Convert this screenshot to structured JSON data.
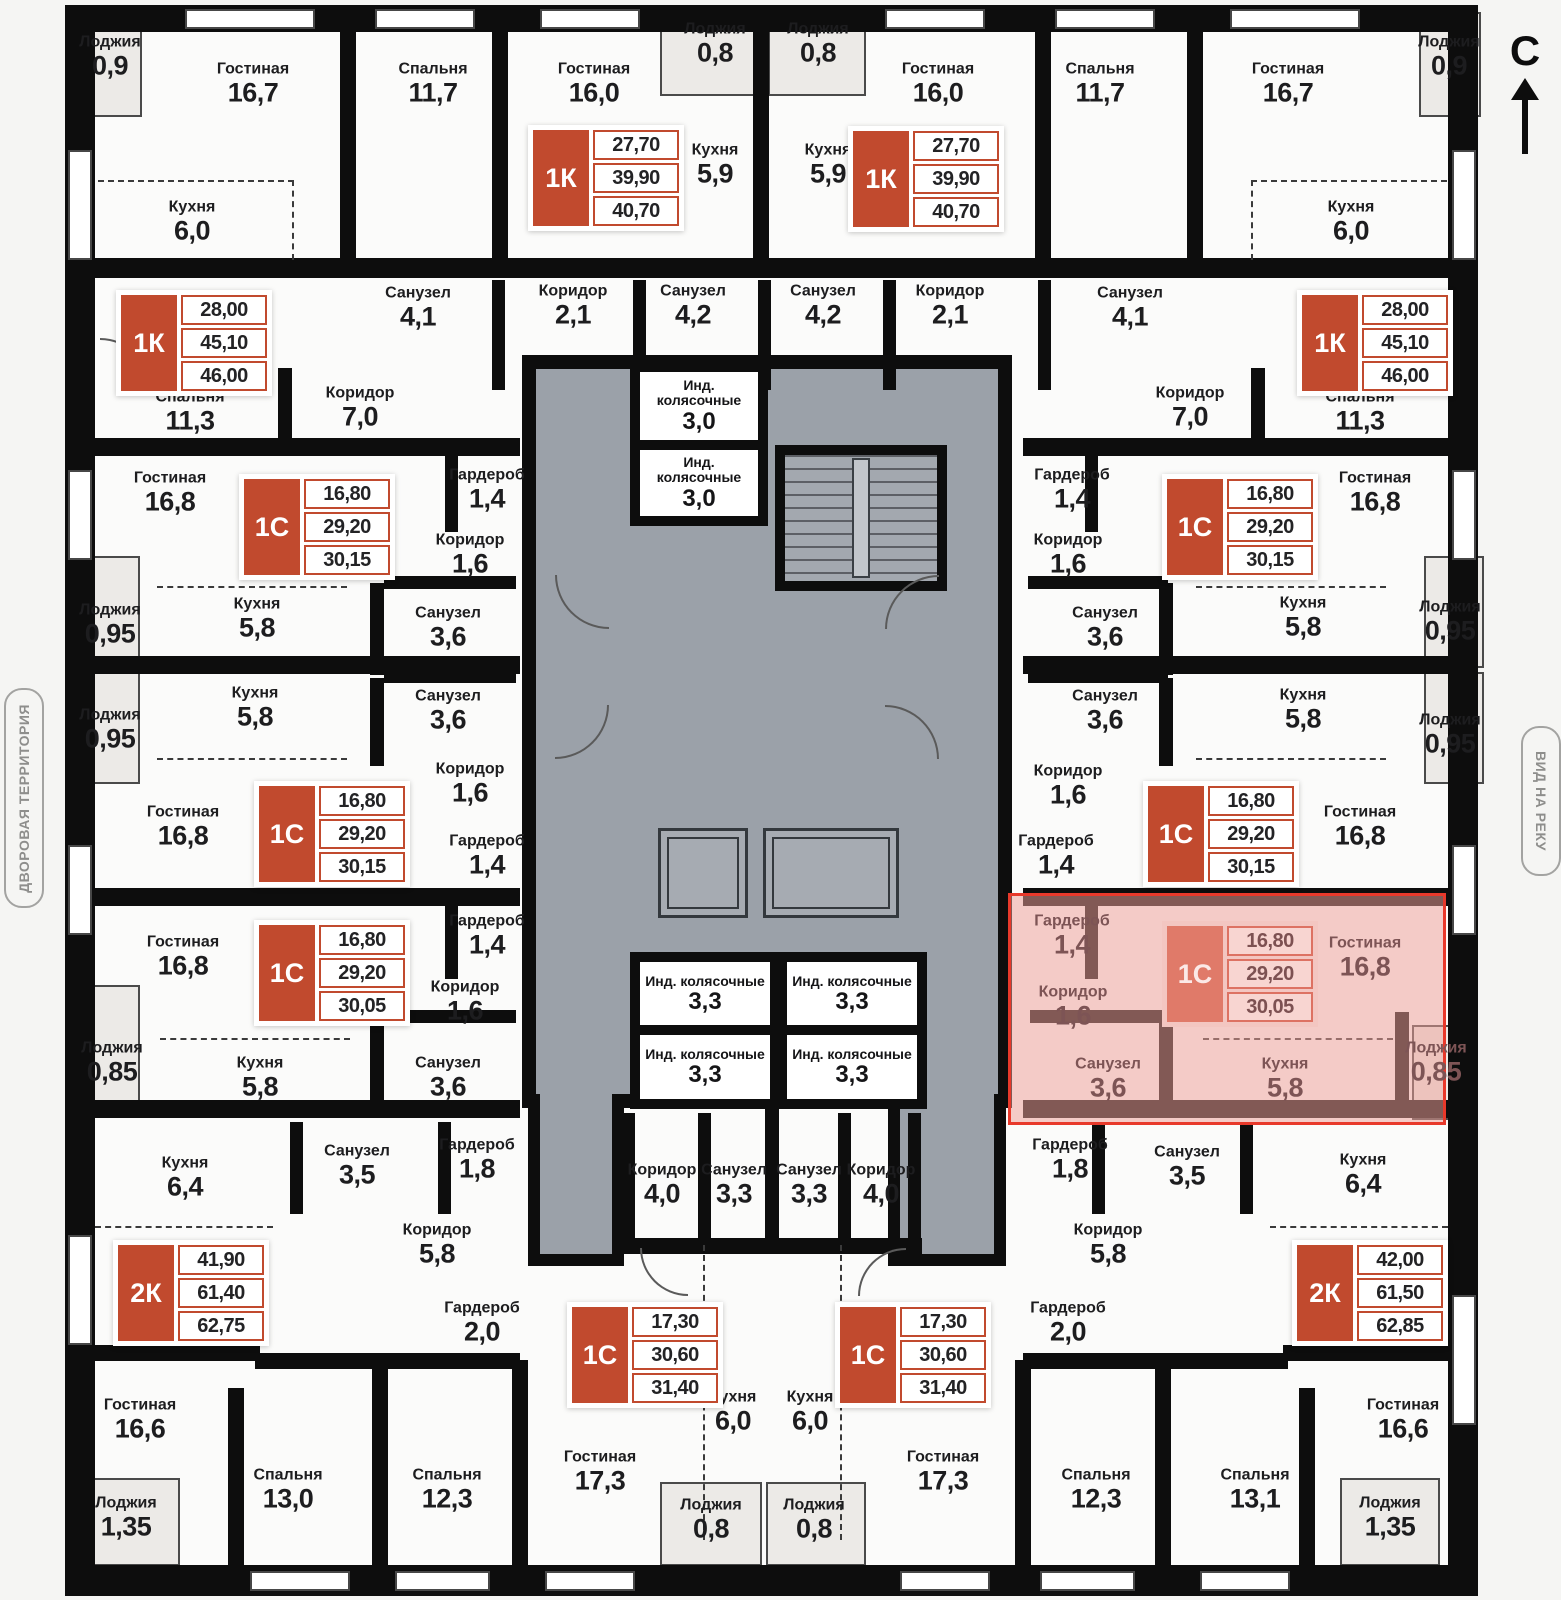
{
  "compass": {
    "label": "С"
  },
  "side_labels": {
    "left": "ДВОРОВАЯ ТЕРРИТОРИЯ",
    "right": "ВИД НА РЕКУ"
  },
  "colors": {
    "card_red": "#c14a2e",
    "wall_black": "#0d0d0d",
    "core_gray": "#9ba1a9",
    "highlight_fill": "#edA098",
    "highlight_border": "#e8392b",
    "highlight_text": "#7d5455"
  },
  "highlight": {
    "x": 1008,
    "y": 893,
    "w": 438,
    "h": 232
  },
  "cards": [
    {
      "type": "1К",
      "values": [
        "27,70",
        "39,90",
        "40,70"
      ],
      "x": 528,
      "y": 125,
      "hl": false
    },
    {
      "type": "1К",
      "values": [
        "27,70",
        "39,90",
        "40,70"
      ],
      "x": 848,
      "y": 126,
      "hl": false
    },
    {
      "type": "1К",
      "values": [
        "28,00",
        "45,10",
        "46,00"
      ],
      "x": 116,
      "y": 290,
      "hl": false
    },
    {
      "type": "1К",
      "values": [
        "28,00",
        "45,10",
        "46,00"
      ],
      "x": 1297,
      "y": 290,
      "hl": false
    },
    {
      "type": "1С",
      "values": [
        "16,80",
        "29,20",
        "30,15"
      ],
      "x": 239,
      "y": 474,
      "hl": false
    },
    {
      "type": "1С",
      "values": [
        "16,80",
        "29,20",
        "30,15"
      ],
      "x": 1162,
      "y": 474,
      "hl": false
    },
    {
      "type": "1С",
      "values": [
        "16,80",
        "29,20",
        "30,15"
      ],
      "x": 254,
      "y": 781,
      "hl": false
    },
    {
      "type": "1С",
      "values": [
        "16,80",
        "29,20",
        "30,15"
      ],
      "x": 1143,
      "y": 781,
      "hl": false
    },
    {
      "type": "1С",
      "values": [
        "16,80",
        "29,20",
        "30,05"
      ],
      "x": 254,
      "y": 920,
      "hl": false
    },
    {
      "type": "1С",
      "values": [
        "16,80",
        "29,20",
        "30,05"
      ],
      "x": 1162,
      "y": 921,
      "hl": true
    },
    {
      "type": "2К",
      "values": [
        "41,90",
        "61,40",
        "62,75"
      ],
      "x": 113,
      "y": 1240,
      "hl": false
    },
    {
      "type": "2К",
      "values": [
        "42,00",
        "61,50",
        "62,85"
      ],
      "x": 1292,
      "y": 1240,
      "hl": false
    },
    {
      "type": "1С",
      "values": [
        "17,30",
        "30,60",
        "31,40"
      ],
      "x": 567,
      "y": 1302,
      "hl": false
    },
    {
      "type": "1С",
      "values": [
        "17,30",
        "30,60",
        "31,40"
      ],
      "x": 835,
      "y": 1302,
      "hl": false
    }
  ],
  "core_boxes": [
    {
      "name": "Инд. колясочные",
      "area": "3,0",
      "x": 640,
      "y": 372,
      "w": 118,
      "h": 68
    },
    {
      "name": "Инд. колясочные",
      "area": "3,0",
      "x": 640,
      "y": 450,
      "w": 118,
      "h": 66
    },
    {
      "name": "Инд. колясочные",
      "area": "3,3",
      "x": 640,
      "y": 962,
      "w": 130,
      "h": 64
    },
    {
      "name": "Инд. колясочные",
      "area": "3,3",
      "x": 787,
      "y": 962,
      "w": 130,
      "h": 64
    },
    {
      "name": "Инд. колясочные",
      "area": "3,3",
      "x": 640,
      "y": 1035,
      "w": 130,
      "h": 64
    },
    {
      "name": "Инд. колясочные",
      "area": "3,3",
      "x": 787,
      "y": 1035,
      "w": 130,
      "h": 64
    }
  ],
  "rooms": [
    {
      "name": "Лоджия",
      "area": "0,9",
      "x": 110,
      "y": 57
    },
    {
      "name": "Гостиная",
      "area": "16,7",
      "x": 253,
      "y": 84
    },
    {
      "name": "Спальня",
      "area": "11,7",
      "x": 433,
      "y": 84
    },
    {
      "name": "Гостиная",
      "area": "16,0",
      "x": 594,
      "y": 84
    },
    {
      "name": "Лоджия",
      "area": "0,8",
      "x": 715,
      "y": 44
    },
    {
      "name": "Лоджия",
      "area": "0,8",
      "x": 818,
      "y": 44
    },
    {
      "name": "Гостиная",
      "area": "16,0",
      "x": 938,
      "y": 84
    },
    {
      "name": "Спальня",
      "area": "11,7",
      "x": 1100,
      "y": 84
    },
    {
      "name": "Гостиная",
      "area": "16,7",
      "x": 1288,
      "y": 84
    },
    {
      "name": "Лоджия",
      "area": "0,9",
      "x": 1449,
      "y": 57
    },
    {
      "name": "Кухня",
      "area": "5,9",
      "x": 715,
      "y": 165
    },
    {
      "name": "Кухня",
      "area": "5,9",
      "x": 828,
      "y": 165
    },
    {
      "name": "Кухня",
      "area": "6,0",
      "x": 192,
      "y": 222
    },
    {
      "name": "Кухня",
      "area": "6,0",
      "x": 1351,
      "y": 222
    },
    {
      "name": "Санузел",
      "area": "4,1",
      "x": 418,
      "y": 308
    },
    {
      "name": "Коридор",
      "area": "2,1",
      "x": 573,
      "y": 306
    },
    {
      "name": "Санузел",
      "area": "4,2",
      "x": 693,
      "y": 306
    },
    {
      "name": "Санузел",
      "area": "4,2",
      "x": 823,
      "y": 306
    },
    {
      "name": "Коридор",
      "area": "2,1",
      "x": 950,
      "y": 306
    },
    {
      "name": "Санузел",
      "area": "4,1",
      "x": 1130,
      "y": 308
    },
    {
      "name": "Спальня",
      "area": "11,3",
      "x": 190,
      "y": 412
    },
    {
      "name": "Коридор",
      "area": "7,0",
      "x": 360,
      "y": 408
    },
    {
      "name": "Коридор",
      "area": "7,0",
      "x": 1190,
      "y": 408
    },
    {
      "name": "Спальня",
      "area": "11,3",
      "x": 1360,
      "y": 412
    },
    {
      "name": "Гостиная",
      "area": "16,8",
      "x": 170,
      "y": 493
    },
    {
      "name": "Гардероб",
      "area": "1,4",
      "x": 487,
      "y": 490
    },
    {
      "name": "Коридор",
      "area": "1,6",
      "x": 470,
      "y": 555
    },
    {
      "name": "Гардероб",
      "area": "1,4",
      "x": 1072,
      "y": 490
    },
    {
      "name": "Коридор",
      "area": "1,6",
      "x": 1068,
      "y": 555
    },
    {
      "name": "Гостиная",
      "area": "16,8",
      "x": 1375,
      "y": 493
    },
    {
      "name": "Лоджия",
      "area": "0,95",
      "x": 110,
      "y": 625
    },
    {
      "name": "Кухня",
      "area": "5,8",
      "x": 257,
      "y": 619
    },
    {
      "name": "Санузел",
      "area": "3,6",
      "x": 448,
      "y": 628
    },
    {
      "name": "Санузел",
      "area": "3,6",
      "x": 1105,
      "y": 628
    },
    {
      "name": "Кухня",
      "area": "5,8",
      "x": 1303,
      "y": 618
    },
    {
      "name": "Лоджия",
      "area": "0,95",
      "x": 1450,
      "y": 622
    },
    {
      "name": "Лоджия",
      "area": "0,95",
      "x": 110,
      "y": 730
    },
    {
      "name": "Кухня",
      "area": "5,8",
      "x": 255,
      "y": 708
    },
    {
      "name": "Санузел",
      "area": "3,6",
      "x": 448,
      "y": 711
    },
    {
      "name": "Санузел",
      "area": "3,6",
      "x": 1105,
      "y": 711
    },
    {
      "name": "Кухня",
      "area": "5,8",
      "x": 1303,
      "y": 710
    },
    {
      "name": "Лоджия",
      "area": "0,95",
      "x": 1450,
      "y": 735
    },
    {
      "name": "Коридор",
      "area": "1,6",
      "x": 470,
      "y": 784
    },
    {
      "name": "Гардероб",
      "area": "1,4",
      "x": 487,
      "y": 856
    },
    {
      "name": "Коридор",
      "area": "1,6",
      "x": 1068,
      "y": 786
    },
    {
      "name": "Гардероб",
      "area": "1,4",
      "x": 1056,
      "y": 856
    },
    {
      "name": "Гостиная",
      "area": "16,8",
      "x": 183,
      "y": 827
    },
    {
      "name": "Гостиная",
      "area": "16,8",
      "x": 1360,
      "y": 827
    },
    {
      "name": "Гостиная",
      "area": "16,8",
      "x": 183,
      "y": 957
    },
    {
      "name": "Гардероб",
      "area": "1,4",
      "x": 487,
      "y": 936
    },
    {
      "name": "Коридор",
      "area": "1,6",
      "x": 465,
      "y": 1002
    },
    {
      "name": "Лоджия",
      "area": "0,85",
      "x": 112,
      "y": 1063
    },
    {
      "name": "Кухня",
      "area": "5,8",
      "x": 260,
      "y": 1078
    },
    {
      "name": "Санузел",
      "area": "3,6",
      "x": 448,
      "y": 1078
    },
    {
      "name": "Гардероб",
      "area": "1,4",
      "x": 1072,
      "y": 936,
      "hl": true
    },
    {
      "name": "Гостиная",
      "area": "16,8",
      "x": 1365,
      "y": 958,
      "hl": true
    },
    {
      "name": "Коридор",
      "area": "1,6",
      "x": 1073,
      "y": 1007,
      "hl": true
    },
    {
      "name": "Санузел",
      "area": "3,6",
      "x": 1108,
      "y": 1079,
      "hl": true
    },
    {
      "name": "Кухня",
      "area": "5,8",
      "x": 1285,
      "y": 1079,
      "hl": true
    },
    {
      "name": "Лоджия",
      "area": "0,85",
      "x": 1436,
      "y": 1063,
      "hl": true
    },
    {
      "name": "Кухня",
      "area": "6,4",
      "x": 185,
      "y": 1178
    },
    {
      "name": "Санузел",
      "area": "3,5",
      "x": 357,
      "y": 1166
    },
    {
      "name": "Гардероб",
      "area": "1,8",
      "x": 477,
      "y": 1160
    },
    {
      "name": "Гардероб",
      "area": "1,8",
      "x": 1070,
      "y": 1160
    },
    {
      "name": "Санузел",
      "area": "3,5",
      "x": 1187,
      "y": 1167
    },
    {
      "name": "Кухня",
      "area": "6,4",
      "x": 1363,
      "y": 1175
    },
    {
      "name": "Коридор",
      "area": "4,0",
      "x": 662,
      "y": 1185
    },
    {
      "name": "Санузел",
      "area": "3,3",
      "x": 734,
      "y": 1185
    },
    {
      "name": "Санузел",
      "area": "3,3",
      "x": 809,
      "y": 1185
    },
    {
      "name": "Коридор",
      "area": "4,0",
      "x": 881,
      "y": 1185
    },
    {
      "name": "Коридор",
      "area": "5,8",
      "x": 437,
      "y": 1245
    },
    {
      "name": "Коридор",
      "area": "5,8",
      "x": 1108,
      "y": 1245
    },
    {
      "name": "Гардероб",
      "area": "2,0",
      "x": 482,
      "y": 1323
    },
    {
      "name": "Гардероб",
      "area": "2,0",
      "x": 1068,
      "y": 1323
    },
    {
      "name": "Гостиная",
      "area": "16,6",
      "x": 140,
      "y": 1420
    },
    {
      "name": "Гостиная",
      "area": "16,6",
      "x": 1403,
      "y": 1420
    },
    {
      "name": "Кухня",
      "area": "6,0",
      "x": 733,
      "y": 1412
    },
    {
      "name": "Кухня",
      "area": "6,0",
      "x": 810,
      "y": 1412
    },
    {
      "name": "Спальня",
      "area": "13,0",
      "x": 288,
      "y": 1490
    },
    {
      "name": "Спальня",
      "area": "12,3",
      "x": 447,
      "y": 1490
    },
    {
      "name": "Гостиная",
      "area": "17,3",
      "x": 600,
      "y": 1472
    },
    {
      "name": "Лоджия",
      "area": "0,8",
      "x": 711,
      "y": 1520
    },
    {
      "name": "Лоджия",
      "area": "0,8",
      "x": 814,
      "y": 1520
    },
    {
      "name": "Гостиная",
      "area": "17,3",
      "x": 943,
      "y": 1472
    },
    {
      "name": "Спальня",
      "area": "12,3",
      "x": 1096,
      "y": 1490
    },
    {
      "name": "Спальня",
      "area": "13,1",
      "x": 1255,
      "y": 1490
    },
    {
      "name": "Лоджия",
      "area": "1,35",
      "x": 126,
      "y": 1518
    },
    {
      "name": "Лоджия",
      "area": "1,35",
      "x": 1390,
      "y": 1518
    }
  ]
}
